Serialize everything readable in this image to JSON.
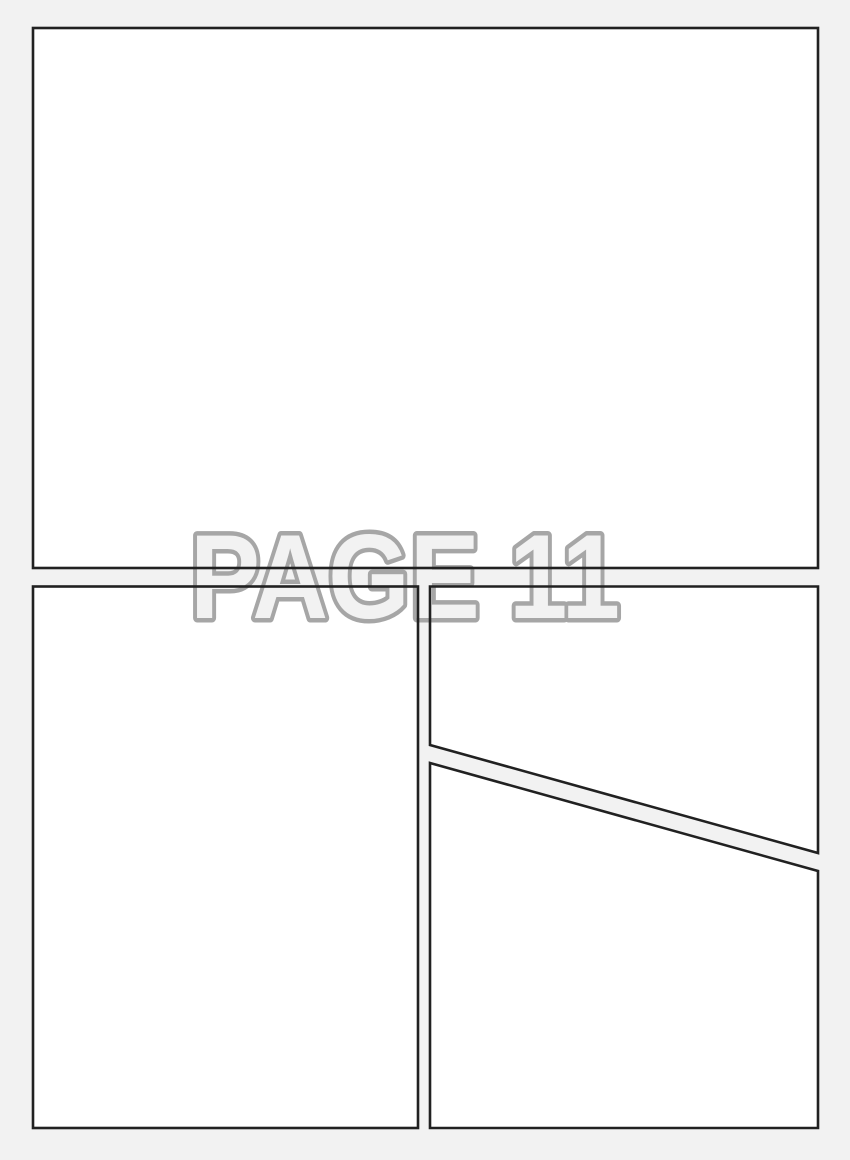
{
  "page": {
    "label": "PAGE 11",
    "colors": {
      "background": "#f2f2f2",
      "panel_fill": "#ffffff",
      "panel_border": "#212121",
      "label_fill": "#f2f2f2",
      "label_outline": "#a6a6a6"
    },
    "panels": [
      {
        "id": "top-panel"
      },
      {
        "id": "bottom-left-panel"
      },
      {
        "id": "top-right-panel"
      },
      {
        "id": "bottom-right-panel"
      }
    ]
  }
}
